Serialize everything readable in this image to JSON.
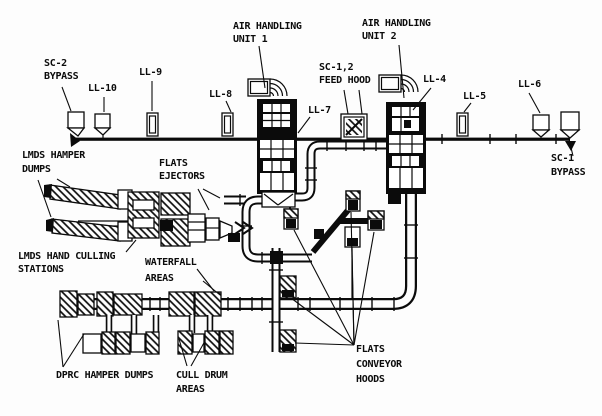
{
  "diagram": {
    "colors": {
      "ink": "#0b0b0b",
      "paper": "#fdfdfd"
    },
    "labels": {
      "ahu1": {
        "lines": [
          "AIR HANDLING",
          "UNIT 1"
        ]
      },
      "ahu2": {
        "lines": [
          "AIR HANDLING",
          "UNIT 2"
        ]
      },
      "sc2_bypass": {
        "lines": [
          "SC-2",
          "BYPASS"
        ]
      },
      "ll10": {
        "lines": [
          "LL-10"
        ]
      },
      "ll9": {
        "lines": [
          "LL-9"
        ]
      },
      "ll8": {
        "lines": [
          "LL-8"
        ]
      },
      "ll7": {
        "lines": [
          "LL-7"
        ]
      },
      "sc12_feed_hood": {
        "lines": [
          "SC-1,2",
          "FEED HOOD"
        ]
      },
      "ll4": {
        "lines": [
          "LL-4"
        ]
      },
      "ll5": {
        "lines": [
          "LL-5"
        ]
      },
      "ll6": {
        "lines": [
          "LL-6"
        ]
      },
      "sc1_bypass": {
        "lines": [
          "SC-1",
          "BYPASS"
        ]
      },
      "lmds_hamper_dumps": {
        "lines": [
          "LMDS HAMPER",
          "DUMPS"
        ]
      },
      "flats_ejectors": {
        "lines": [
          "FLATS",
          "EJECTORS"
        ]
      },
      "lmds_hand_culling_stations": {
        "lines": [
          "LMDS HAND CULLING",
          "STATIONS"
        ]
      },
      "waterfall_areas": {
        "lines": [
          "WATERFALL",
          "AREAS"
        ]
      },
      "dprc_hamper_dumps": {
        "lines": [
          "DPRC HAMPER DUMPS"
        ]
      },
      "cull_drum_areas": {
        "lines": [
          "CULL DRUM",
          "AREAS"
        ]
      },
      "flats_conveyor_hoods": {
        "lines": [
          "FLATS",
          "CONVEYOR",
          "HOODS"
        ]
      }
    }
  }
}
